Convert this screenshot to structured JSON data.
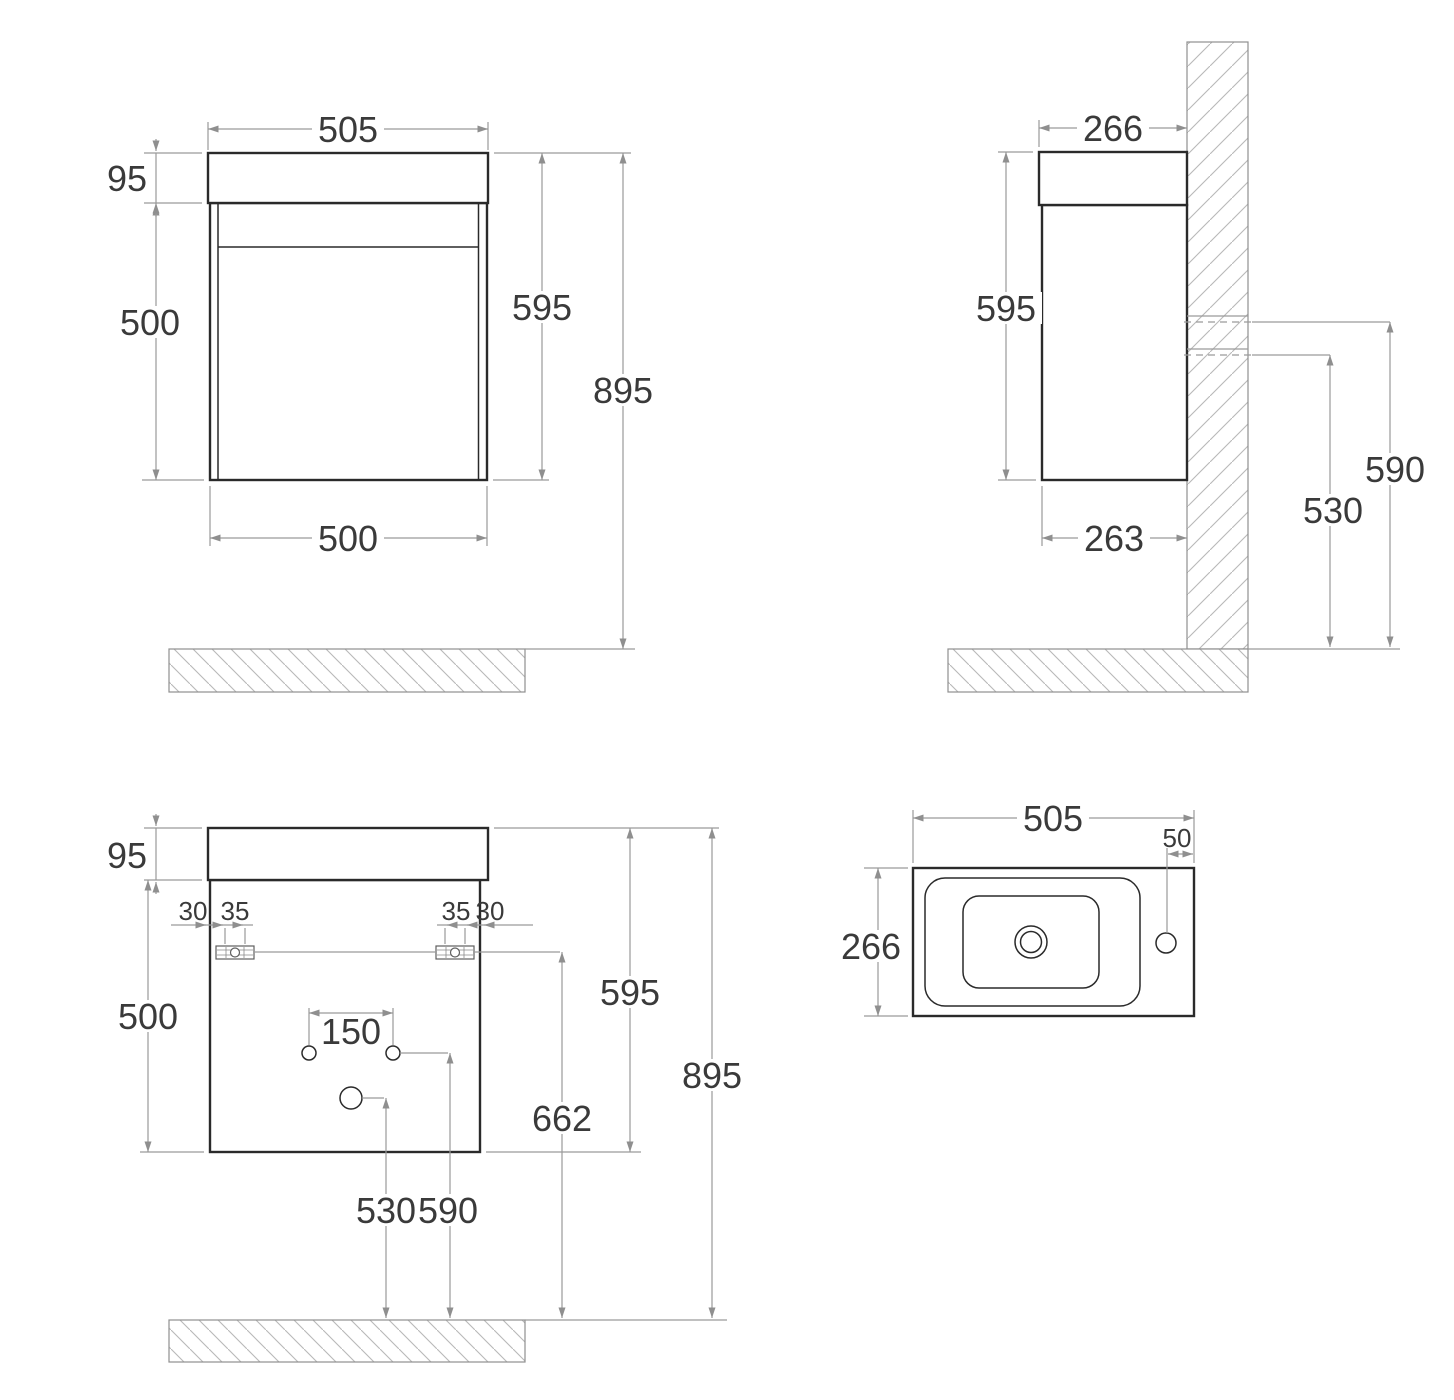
{
  "views": {
    "front": {
      "dims": {
        "width_top": "505",
        "basin_height": "95",
        "cabinet_height": "500",
        "width_bottom": "500",
        "unit_height": "595",
        "total_height": "895"
      }
    },
    "side": {
      "dims": {
        "depth_top": "266",
        "unit_height": "595",
        "depth_bottom": "263",
        "supply_height": "590",
        "outlet_height": "530"
      }
    },
    "back": {
      "dims": {
        "basin_height": "95",
        "cabinet_height": "500",
        "edge_offset_left": "30",
        "bracket_offset_left": "35",
        "bracket_offset_right": "35",
        "edge_offset_right": "30",
        "hole_spacing": "150",
        "unit_height": "595",
        "bracket_height": "662",
        "total_height": "895",
        "outlet_height": "530",
        "supply_height": "590"
      }
    },
    "top": {
      "dims": {
        "width": "505",
        "tap_offset": "50",
        "depth": "266"
      }
    }
  }
}
